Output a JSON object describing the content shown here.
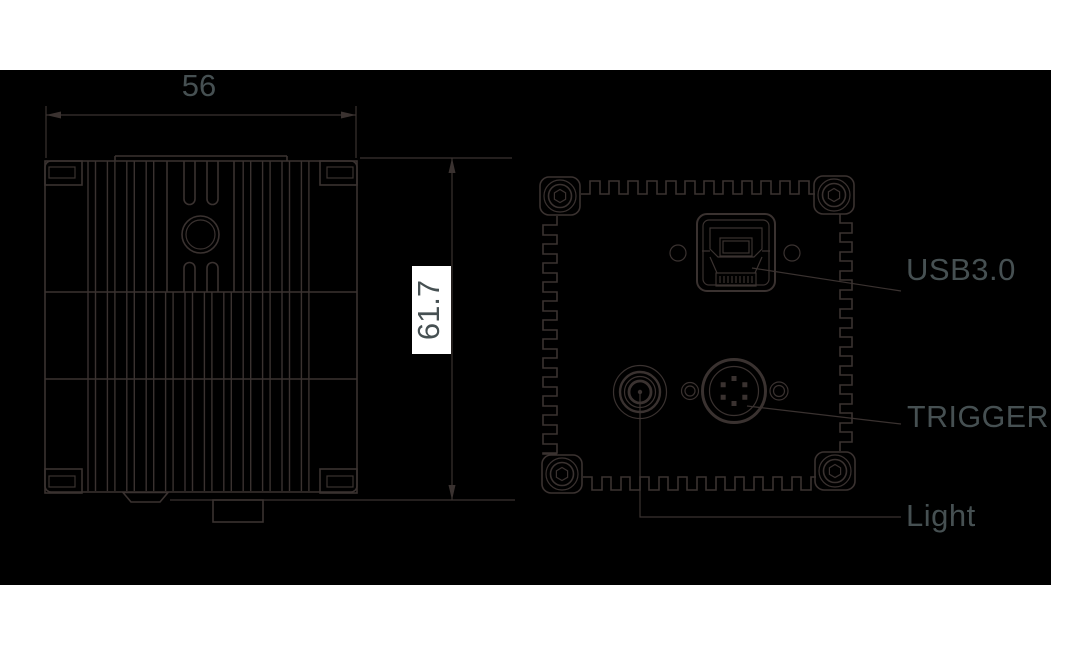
{
  "title": "camera-dimension-drawing",
  "dimensions": {
    "width_label": "56",
    "width_value_mm": 56,
    "height_label": "61.7",
    "height_value_mm": 61.7
  },
  "connector_labels": {
    "usb": "USB3.0",
    "trigger": "TRIGGER",
    "light": "Light"
  },
  "colors": {
    "background": "#ffffff",
    "panel": "#000000",
    "line": "#3a3230",
    "text": "#465052",
    "dim_label_box": "#ffffff"
  },
  "symbols": {
    "usb_connector_icon": "usb-b-port-outline",
    "trigger_connector_icon": "circular-6-pin-connector",
    "light_connector_icon": "concentric-ring-jack",
    "mount_ear_icon": "rounded-square-with-hex-screw",
    "screw_hole_icon": "small-circle",
    "heatsink_icon": "vertical-fin-lines"
  }
}
